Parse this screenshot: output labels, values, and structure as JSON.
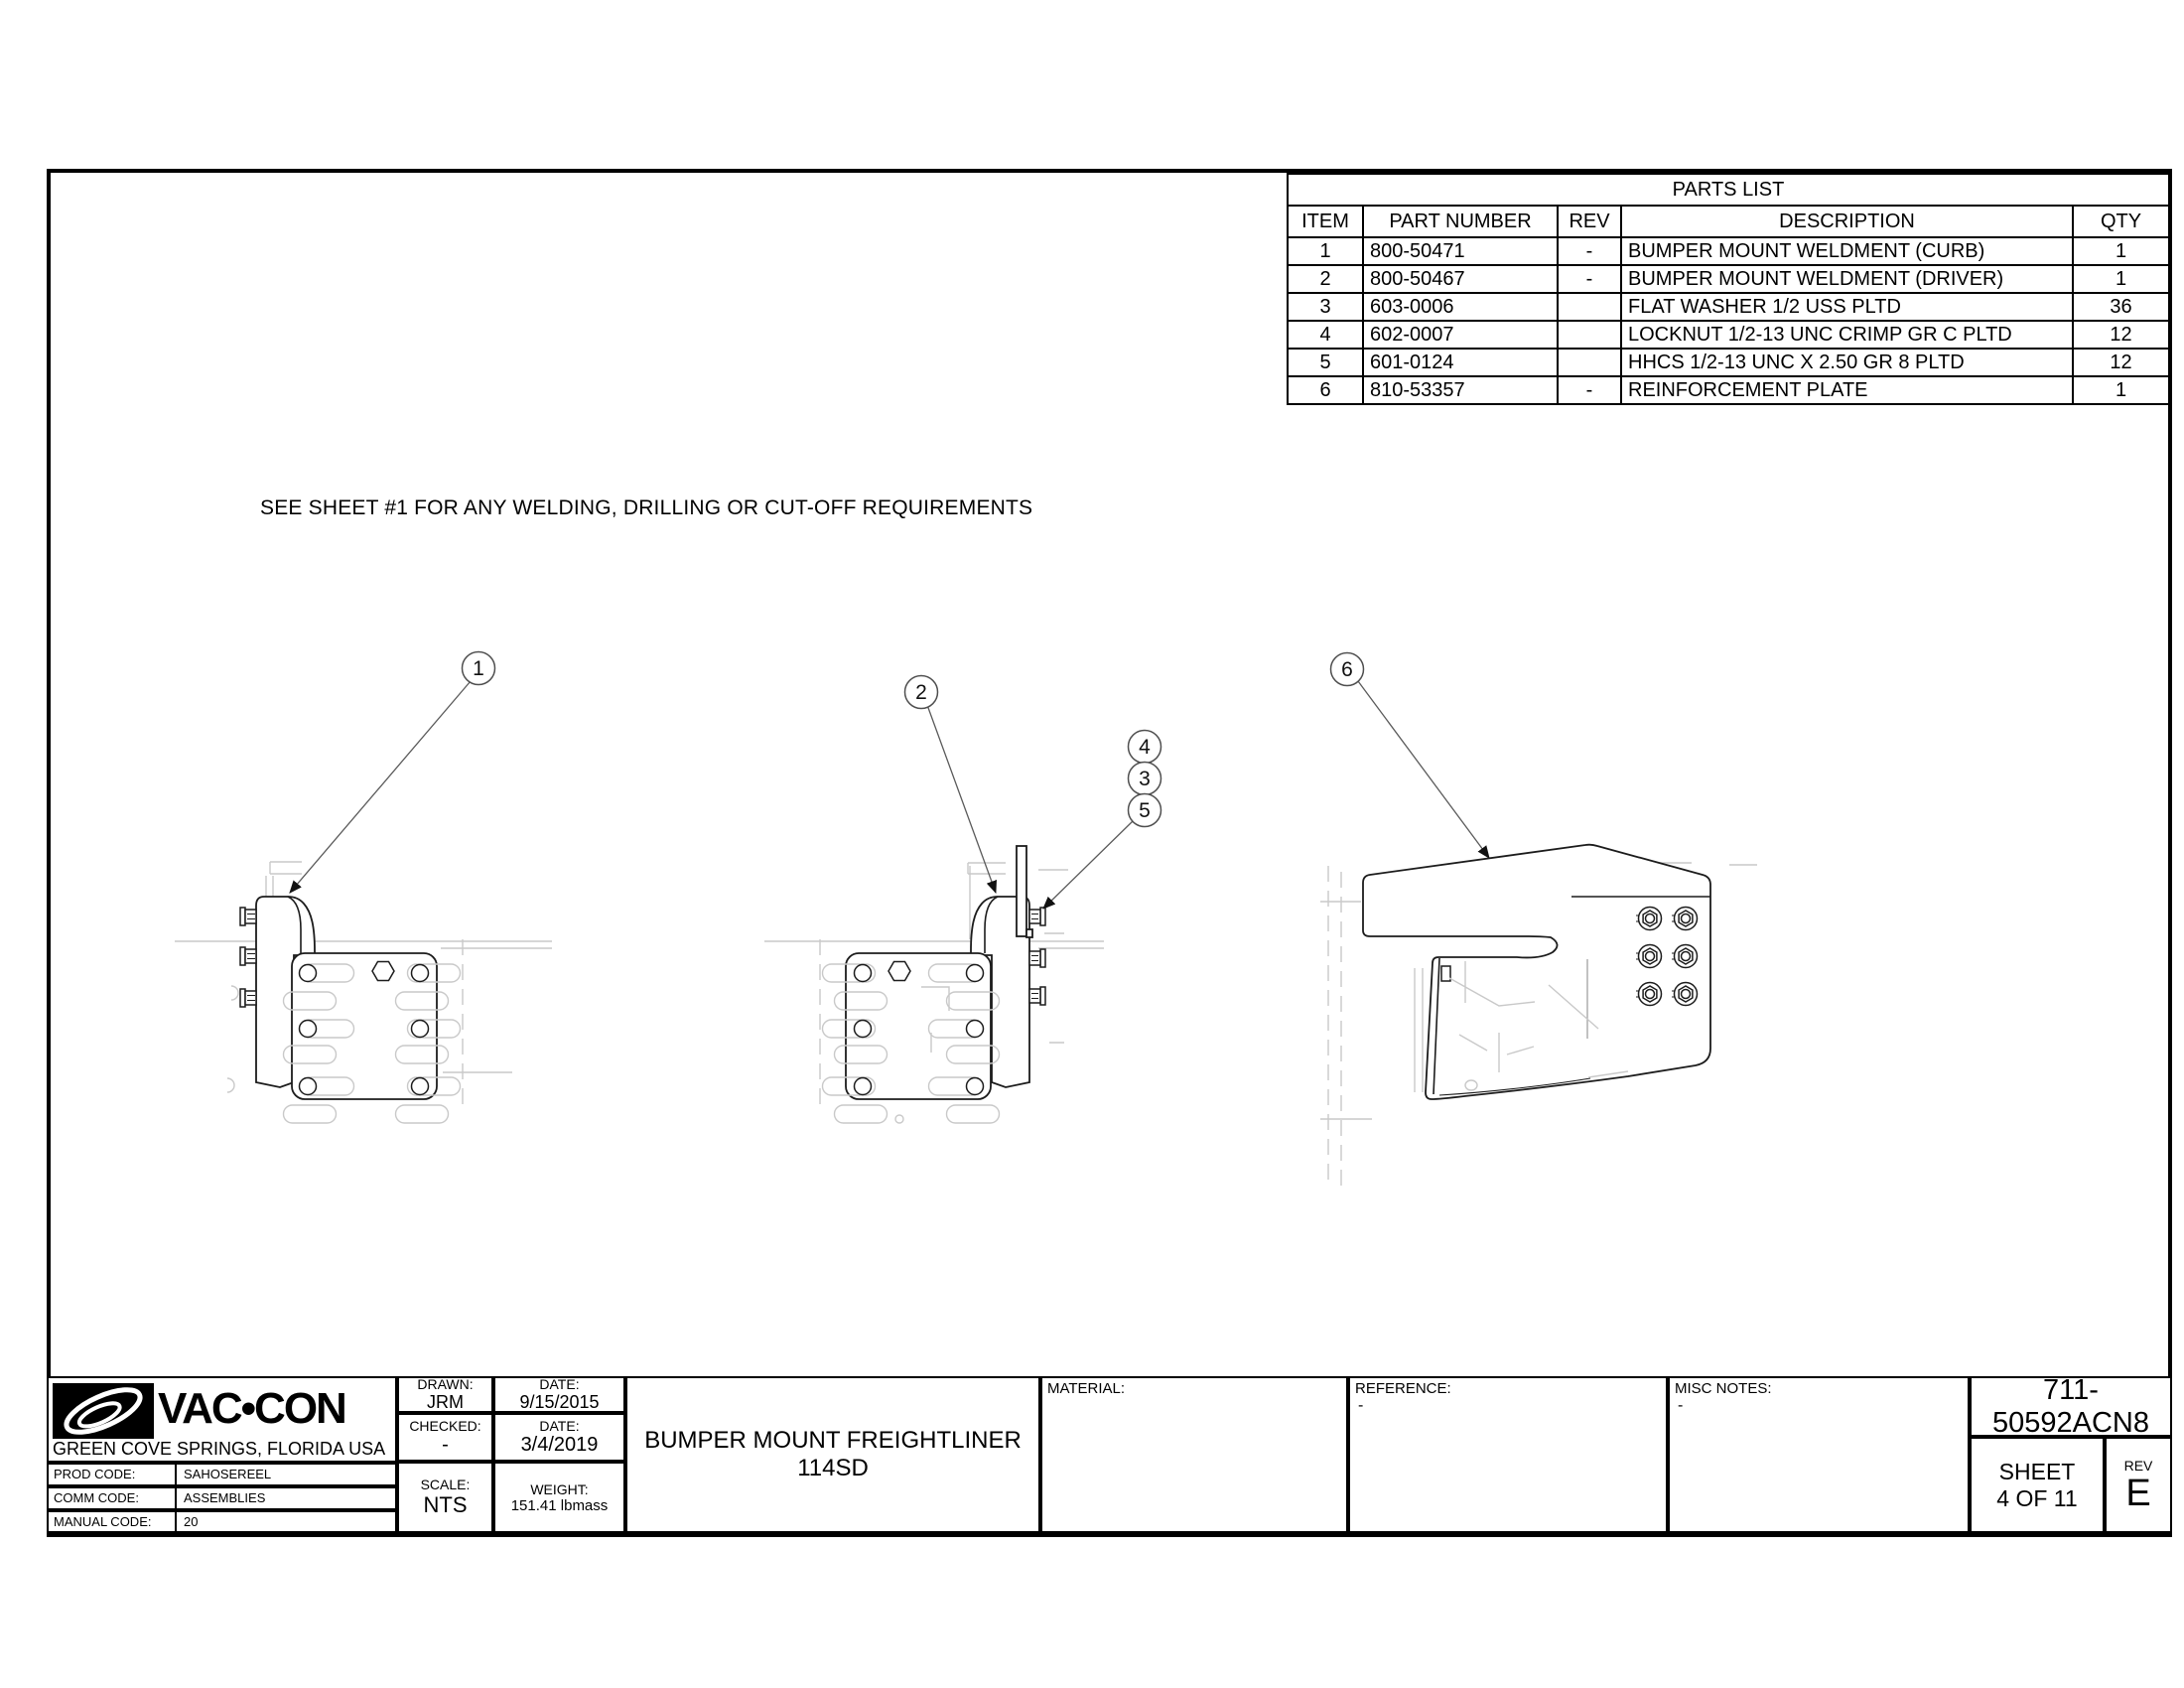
{
  "page": {
    "note": "SEE SHEET #1 FOR ANY WELDING, DRILLING OR CUT-OFF REQUIREMENTS"
  },
  "parts_list": {
    "title": "PARTS LIST",
    "headers": {
      "item": "ITEM",
      "part_number": "PART NUMBER",
      "rev": "REV",
      "description": "DESCRIPTION",
      "qty": "QTY"
    },
    "rows": [
      {
        "item": "1",
        "part_number": "800-50471",
        "rev": "-",
        "description": "BUMPER MOUNT WELDMENT (CURB)",
        "qty": "1"
      },
      {
        "item": "2",
        "part_number": "800-50467",
        "rev": "-",
        "description": "BUMPER MOUNT WELDMENT (DRIVER)",
        "qty": "1"
      },
      {
        "item": "3",
        "part_number": "603-0006",
        "rev": "",
        "description": "FLAT WASHER 1/2 USS PLTD",
        "qty": "36"
      },
      {
        "item": "4",
        "part_number": "602-0007",
        "rev": "",
        "description": "LOCKNUT 1/2-13 UNC CRIMP GR C PLTD",
        "qty": "12"
      },
      {
        "item": "5",
        "part_number": "601-0124",
        "rev": "",
        "description": "HHCS 1/2-13 UNC X 2.50 GR 8 PLTD",
        "qty": "12"
      },
      {
        "item": "6",
        "part_number": "810-53357",
        "rev": "-",
        "description": "REINFORCEMENT PLATE",
        "qty": "1"
      }
    ]
  },
  "balloons": {
    "b1": "1",
    "b2": "2",
    "b3": "3",
    "b4": "4",
    "b5": "5",
    "b6": "6"
  },
  "title_block": {
    "logo_text": "VAC•CON",
    "address": "GREEN COVE SPRINGS, FLORIDA USA",
    "prod_label": "PROD CODE:",
    "prod": "SAHOSEREEL",
    "comm_label": "COMM CODE:",
    "comm": "ASSEMBLIES",
    "manual_label": "MANUAL CODE:",
    "manual": "20",
    "drawn_label": "DRAWN:",
    "drawn": "JRM",
    "date1_label": "DATE:",
    "date1": "9/15/2015",
    "checked_label": "CHECKED:",
    "checked": "-",
    "date2_label": "DATE:",
    "date2": "3/4/2019",
    "scale_label": "SCALE:",
    "scale": "NTS",
    "weight_label": "WEIGHT:",
    "weight": "151.41 lbmass",
    "title": "BUMPER MOUNT FREIGHTLINER 114SD",
    "material_label": "MATERIAL:",
    "material": "",
    "reference_label": "REFERENCE:",
    "reference": "-",
    "misc_label": "MISC NOTES:",
    "misc": "-",
    "drawing_number": "711-50592ACN8",
    "sheet_label": "SHEET",
    "sheet": "4 OF 11",
    "rev_label": "REV",
    "rev": "E"
  }
}
